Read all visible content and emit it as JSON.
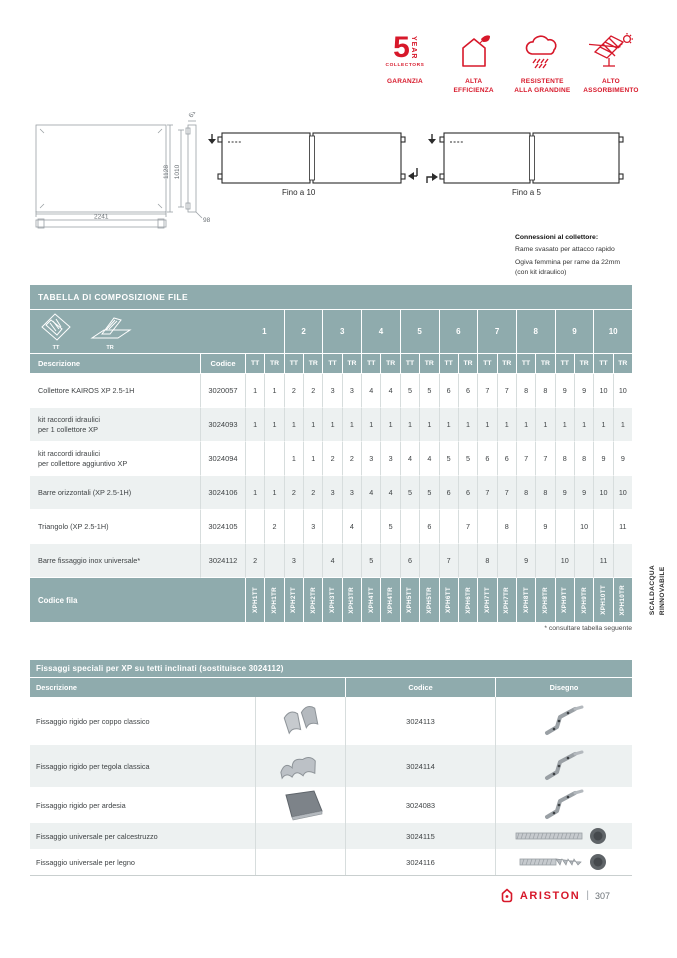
{
  "colors": {
    "accent_red": "#d7182a",
    "header_teal": "#8fabad",
    "row_alt": "#edf1f1"
  },
  "badges": {
    "warranty": {
      "number": "5",
      "year": "YEAR",
      "collectors": "COLLECTORS",
      "label": "GARANZIA"
    },
    "items": [
      {
        "icon": "house-leaf-icon",
        "label": "ALTA\nEFFICIENZA"
      },
      {
        "icon": "cloud-hail-icon",
        "label": "RESISTENTE\nALLA GRANDINE"
      },
      {
        "icon": "panel-sun-icon",
        "label": "ALTO\nASSORBIMENTO"
      }
    ]
  },
  "drawings": {
    "dim_width": "2241",
    "dim_height_outer": "1128",
    "dim_height_inner": "1010",
    "dim_top": "61",
    "dim_depth": "98",
    "series_tt_label": "Fino a 10",
    "series_tr_label": "Fino a  5",
    "connections_title": "Connessioni al collettore:",
    "connections_line1": "Rame svasato per attacco rapido",
    "connections_line2": "Ogiva femmina per rame da 22mm",
    "connections_line3": "(con kit idraulico)"
  },
  "table1": {
    "title": "TABELLA DI COMPOSIZIONE FILE",
    "tt_label": "TT",
    "tr_label": "TR",
    "groups": [
      "1",
      "2",
      "3",
      "4",
      "5",
      "6",
      "7",
      "8",
      "9",
      "10"
    ],
    "col_descrizione": "Descrizione",
    "col_codice": "Codice",
    "rows": [
      {
        "desc": "Collettore KAIROS XP 2.5-1H",
        "code": "3020057",
        "values": [
          "1",
          "1",
          "2",
          "2",
          "3",
          "3",
          "4",
          "4",
          "5",
          "5",
          "6",
          "6",
          "7",
          "7",
          "8",
          "8",
          "9",
          "9",
          "10",
          "10"
        ]
      },
      {
        "desc": "kit raccordi idraulici\nper 1 collettore XP",
        "code": "3024093",
        "values": [
          "1",
          "1",
          "1",
          "1",
          "1",
          "1",
          "1",
          "1",
          "1",
          "1",
          "1",
          "1",
          "1",
          "1",
          "1",
          "1",
          "1",
          "1",
          "1",
          "1"
        ]
      },
      {
        "desc": "kit raccordi idraulici\nper collettore aggiuntivo XP",
        "code": "3024094",
        "values": [
          "",
          "",
          "1",
          "1",
          "2",
          "2",
          "3",
          "3",
          "4",
          "4",
          "5",
          "5",
          "6",
          "6",
          "7",
          "7",
          "8",
          "8",
          "9",
          "9"
        ]
      },
      {
        "desc": "Barre orizzontali (XP 2.5-1H)",
        "code": "3024106",
        "values": [
          "1",
          "1",
          "2",
          "2",
          "3",
          "3",
          "4",
          "4",
          "5",
          "5",
          "6",
          "6",
          "7",
          "7",
          "8",
          "8",
          "9",
          "9",
          "10",
          "10"
        ]
      },
      {
        "desc": "Triangolo (XP 2.5-1H)",
        "code": "3024105",
        "values": [
          "",
          "2",
          "",
          "3",
          "",
          "4",
          "",
          "5",
          "",
          "6",
          "",
          "7",
          "",
          "8",
          "",
          "9",
          "",
          "10",
          "",
          "11"
        ]
      },
      {
        "desc": "Barre fissaggio inox universale*",
        "code": "3024112",
        "values": [
          "2",
          "",
          "3",
          "",
          "4",
          "",
          "5",
          "",
          "6",
          "",
          "7",
          "",
          "8",
          "",
          "9",
          "",
          "10",
          "",
          "11",
          ""
        ]
      }
    ],
    "codice_fila_label": "Codice fila",
    "row_codes": [
      "XPH1TT",
      "XPH1TR",
      "XPH2TT",
      "XPH2TR",
      "XPH3TT",
      "XPH3TR",
      "XPH4TT",
      "XPH4TR",
      "XPH5TT",
      "XPH5TR",
      "XPH6TT",
      "XPH6TR",
      "XPH7TT",
      "XPH7TR",
      "XPH8TT",
      "XPH8TR",
      "XPH9TT",
      "XPH9TR",
      "XPH10TT",
      "XPH10TR"
    ],
    "footnote": "* consultare tabella seguente"
  },
  "side_tab": {
    "line1": "SCALDACQUA",
    "line2": "RINNOVABILE"
  },
  "table2": {
    "title": "Fissaggi speciali per XP su tetti inclinati (sostituisce 3024112)",
    "col_descrizione": "Descrizione",
    "col_codice": "Codice",
    "col_disegno": "Disegno",
    "rows": [
      {
        "desc": "Fissaggio rigido per coppo classico",
        "code": "3024113",
        "photo": "coppo-tile",
        "drawing": "roof-bracket"
      },
      {
        "desc": "Fissaggio rigido per tegola classica",
        "code": "3024114",
        "photo": "tegola-tile",
        "drawing": "roof-bracket"
      },
      {
        "desc": "Fissaggio rigido per ardesia",
        "code": "3024083",
        "photo": "slate-tile",
        "drawing": "roof-bracket"
      },
      {
        "desc": "Fissaggio universale per calcestruzzo",
        "code": "3024115",
        "photo": "",
        "drawing": "threaded-rod"
      },
      {
        "desc": "Fissaggio universale per legno",
        "code": "3024116",
        "photo": "",
        "drawing": "wood-screw"
      }
    ]
  },
  "footer": {
    "brand": "ARISTON",
    "separator": "|",
    "page_number": "307"
  }
}
